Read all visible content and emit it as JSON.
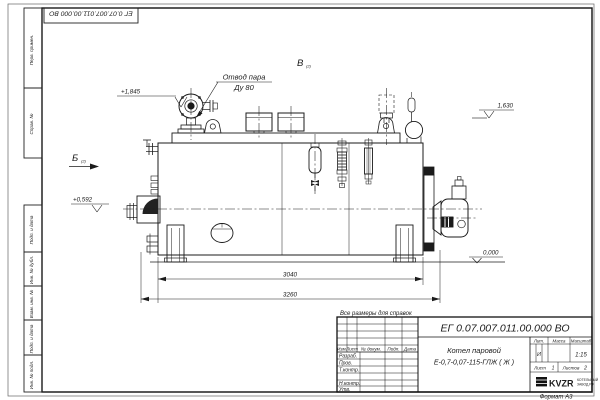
{
  "sheet": {
    "top_designation_inverted": "ЕГ 0.07.007.011.00.000 ВО",
    "format_note": "Формат А3",
    "side_columns": [
      {
        "label": "Перв. примен."
      },
      {
        "label": "Справ. №"
      },
      {
        "label": "Подп. и дата"
      },
      {
        "label": "Инв. № дубл."
      },
      {
        "label": "Взам. инв. №"
      },
      {
        "label": "Подп. и дата"
      },
      {
        "label": "Инв. № подл."
      }
    ]
  },
  "drawing": {
    "callout": {
      "line1": "Отвод пара",
      "line2": "Ду 80"
    },
    "view_markers": {
      "b": "Б",
      "v": "В",
      "sub": "(2)"
    },
    "elevations": {
      "top_left": "+1,845",
      "right": "1,630",
      "left": "+0,592",
      "ground": "0,000"
    },
    "dimensions": {
      "body_length": "3040",
      "overall_length": "3260"
    }
  },
  "title_block": {
    "note": "Все размеры для справок",
    "designation": "ЕГ 0.07.007.011.00.000 ВО",
    "product": {
      "line1": "Котел паровой",
      "line2": "Е-0,7-0,07-115-ГЛЖ ( Ж )"
    },
    "columns": {
      "izm": "Изм.",
      "list": "Лист",
      "doc": "№ докум.",
      "sign": "Подп.",
      "date": "Дата"
    },
    "roles": [
      "Разраб.",
      "Пров.",
      "Т.контр.",
      "",
      "Н.контр.",
      "Утв."
    ],
    "lit": {
      "label": "Лит.",
      "value": "И"
    },
    "mass": {
      "label": "Масса"
    },
    "scale": {
      "label": "Масштаб",
      "value": "1:15"
    },
    "sheet_no": {
      "label": "Лист",
      "value": "1"
    },
    "sheets": {
      "label": "Листов",
      "value": "2"
    },
    "company": {
      "name": "KVZR",
      "tagline1": "КОТЕЛЬНЫЙ",
      "tagline2": "ЗАВОД.РФ"
    }
  }
}
